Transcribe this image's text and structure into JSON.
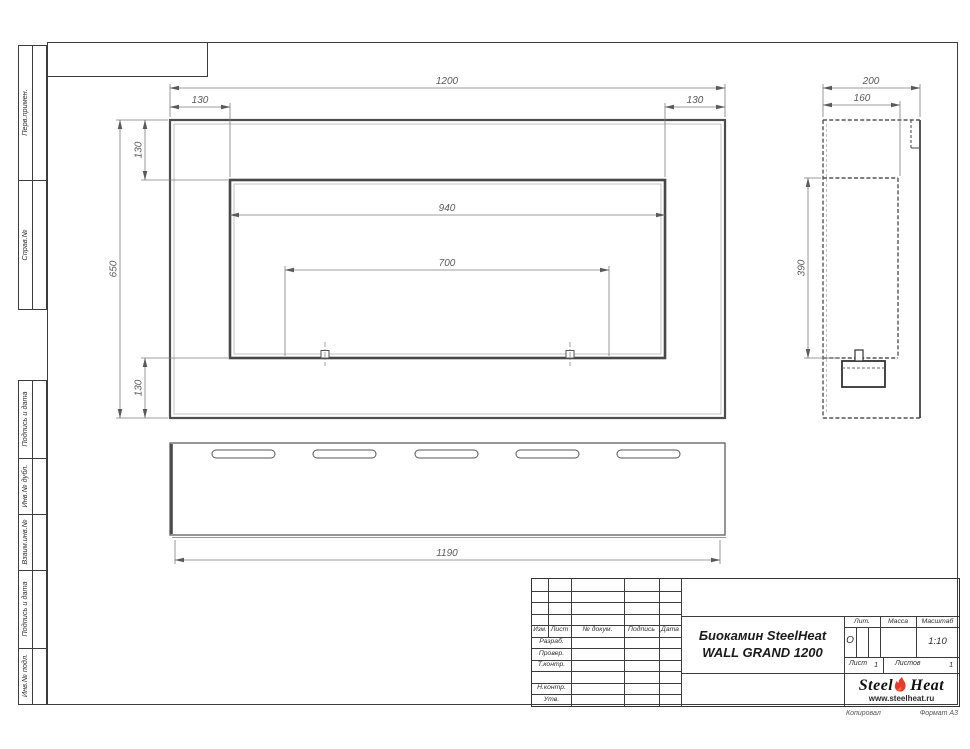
{
  "side_columns": {
    "top": [
      "Перв.примен.",
      "Справ.№"
    ],
    "bottom": [
      "Подпись и дата",
      "Инв.№ дубл.",
      "Взаим.инв.№",
      "Подпись и дата",
      "Инв.№ подл."
    ]
  },
  "title_block": {
    "header": {
      "izm": "Изм.",
      "list": "Лист",
      "doc": "№ докум.",
      "podpis": "Подпись",
      "data": "Дата"
    },
    "rows": [
      "Разраб.",
      "Провер.",
      "Т.контр.",
      "",
      "Н.контр.",
      "Утв."
    ],
    "title_line1": "Биокамин SteelHeat",
    "title_line2": "WALL GRAND 1200",
    "lit_label": "Лит.",
    "lit_value": "О",
    "massa_label": "Масса",
    "massa_value": "",
    "scale_label": "Масштаб",
    "scale_value": "1:10",
    "sheet_label": "Лист",
    "sheet_value": "1",
    "sheets_label": "Листов",
    "sheets_value": "1",
    "logo_steel": "Steel",
    "logo_heat": "Heat",
    "logo_url": "www.steelheat.ru",
    "kopiroval": "Копировал",
    "format": "Формат А3"
  },
  "dims": {
    "front": {
      "total_w": "1200",
      "off_l": "130",
      "off_r": "130",
      "off_t": "130",
      "off_b": "130",
      "opening_w": "940",
      "burner_w": "700",
      "total_h": "650"
    },
    "side": {
      "depth": "200",
      "inner_depth": "160",
      "inner_h": "390"
    },
    "bottom": {
      "length": "1190"
    }
  },
  "colors": {
    "line_thick": "#4d4d4d",
    "line_thin": "#808080",
    "dim_text": "#5a5a5a",
    "flame_red": "#e8392b",
    "flame_inner": "#ff7a30"
  }
}
